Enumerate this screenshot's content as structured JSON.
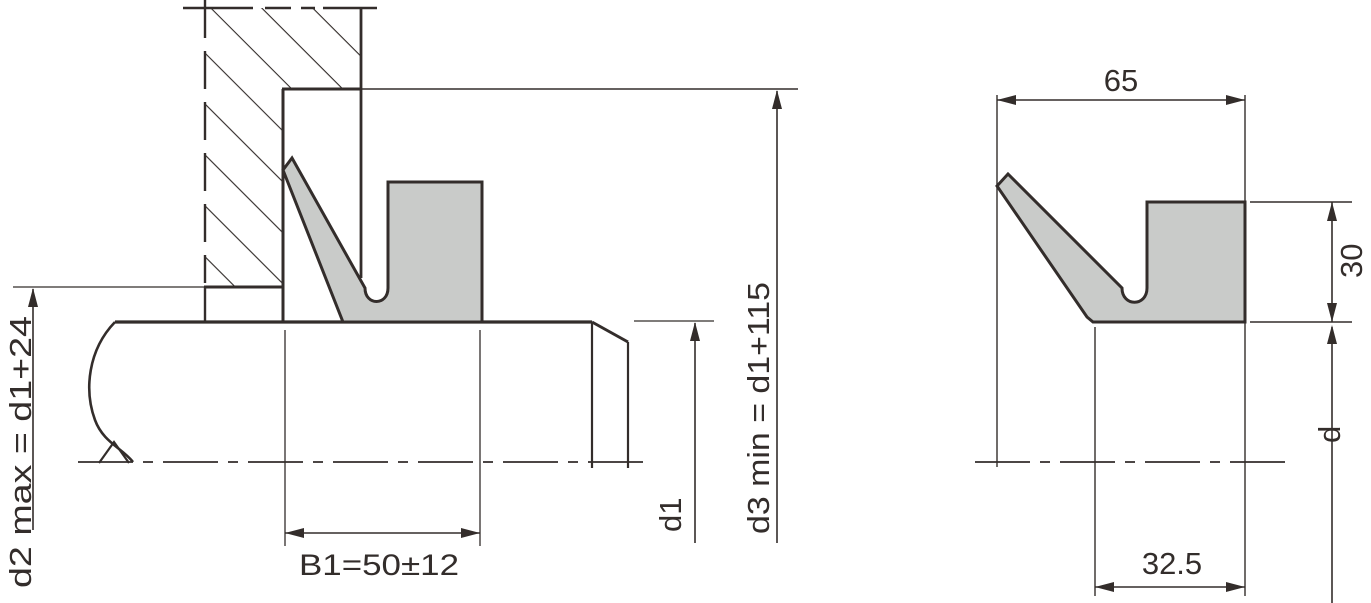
{
  "meta": {
    "title": "V-ring shaft seal technical drawing",
    "type": "engineering-cross-section"
  },
  "colors": {
    "line": "#332d2b",
    "seal_fill": "#c9cbc9",
    "background": "#ffffff"
  },
  "left_view": {
    "name": "installed seal in housing",
    "labels": {
      "d2_max": "d2 max = d1+24",
      "b1": "B1=50±12",
      "d1": "d1",
      "d3_min": "d3 min = d1+115"
    }
  },
  "right_view": {
    "name": "seal profile",
    "labels": {
      "width": "65",
      "height": "30",
      "body_width": "32.5",
      "shaft_dia": "d"
    }
  }
}
